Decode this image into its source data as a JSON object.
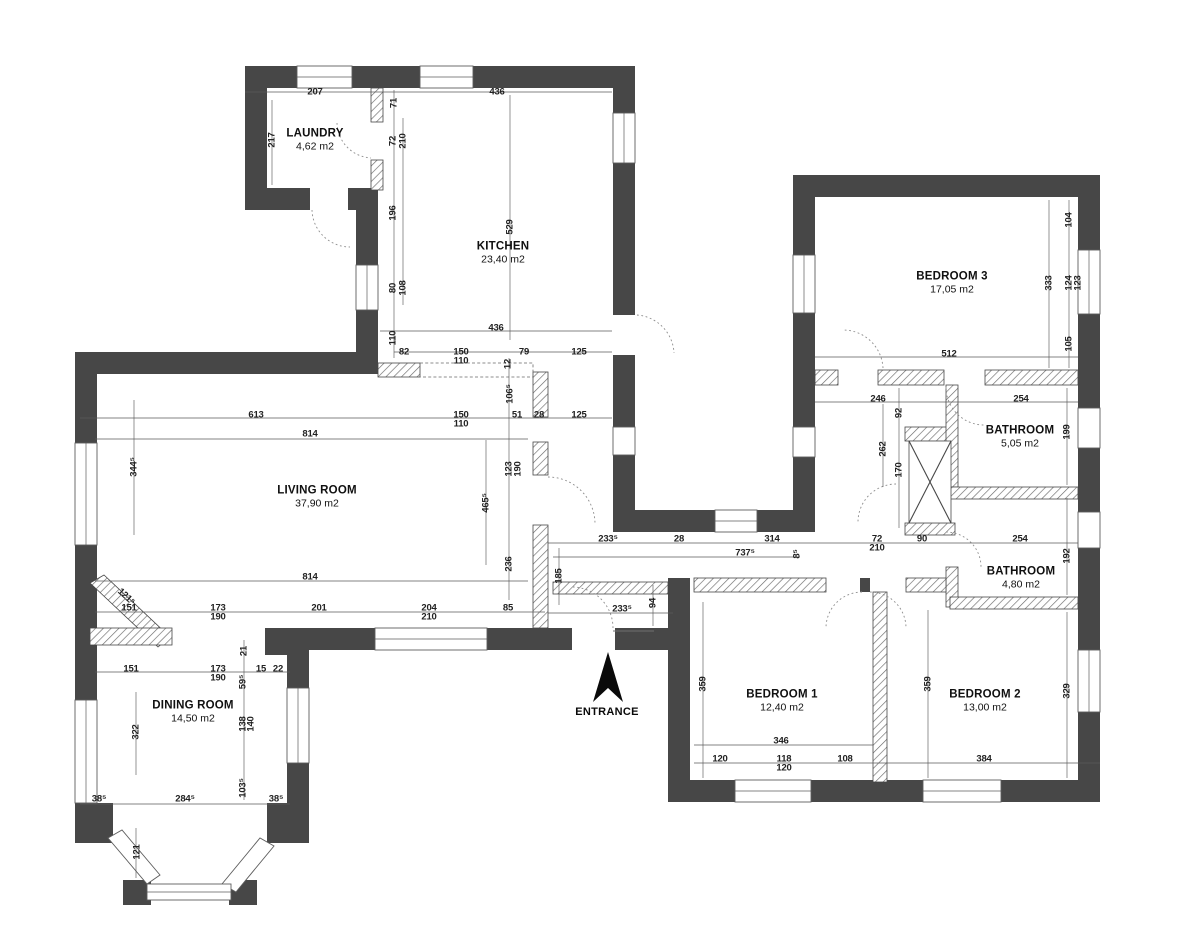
{
  "colors": {
    "wall": "#474747",
    "hatch_line": "#6a6a6a",
    "dim_text": "#222222",
    "arrow": "#0a0a0a"
  },
  "entrance": {
    "label": "ENTRANCE"
  },
  "rooms": [
    {
      "id": "laundry",
      "name": "LAUNDRY",
      "area": "4,62 m2",
      "x": 315,
      "y": 140
    },
    {
      "id": "kitchen",
      "name": "KITCHEN",
      "area": "23,40 m2",
      "x": 503,
      "y": 253
    },
    {
      "id": "living-room",
      "name": "LIVING ROOM",
      "area": "37,90 m2",
      "x": 317,
      "y": 497
    },
    {
      "id": "dining-room",
      "name": "DINING ROOM",
      "area": "14,50 m2",
      "x": 193,
      "y": 712
    },
    {
      "id": "bedroom-3",
      "name": "BEDROOM 3",
      "area": "17,05 m2",
      "x": 952,
      "y": 283
    },
    {
      "id": "bathroom-1",
      "name": "BATHROOM",
      "area": "5,05 m2",
      "x": 1020,
      "y": 437
    },
    {
      "id": "bathroom-2",
      "name": "BATHROOM",
      "area": "4,80 m2",
      "x": 1021,
      "y": 578
    },
    {
      "id": "bedroom-1",
      "name": "BEDROOM 1",
      "area": "12,40 m2",
      "x": 782,
      "y": 701
    },
    {
      "id": "bedroom-2",
      "name": "BEDROOM 2",
      "area": "13,00 m2",
      "x": 985,
      "y": 701
    }
  ],
  "dimensions": [
    {
      "t": "207",
      "x": 315,
      "y": 92,
      "r": 0
    },
    {
      "t": "436",
      "x": 497,
      "y": 92,
      "r": 0
    },
    {
      "t": "217",
      "x": 272,
      "y": 140,
      "r": 90
    },
    {
      "t": "71",
      "x": 394,
      "y": 103,
      "r": 90
    },
    {
      "t": "72",
      "x": 393,
      "y": 141,
      "r": 90
    },
    {
      "t": "210",
      "x": 403,
      "y": 141,
      "r": 90
    },
    {
      "t": "196",
      "x": 393,
      "y": 213,
      "r": 90
    },
    {
      "t": "529",
      "x": 510,
      "y": 227,
      "r": 90
    },
    {
      "t": "80",
      "x": 393,
      "y": 288,
      "r": 90
    },
    {
      "t": "108",
      "x": 403,
      "y": 288,
      "r": 90
    },
    {
      "t": "110",
      "x": 393,
      "y": 338,
      "r": 90
    },
    {
      "t": "436",
      "x": 496,
      "y": 328,
      "r": 0
    },
    {
      "t": "82",
      "x": 404,
      "y": 352,
      "r": 0
    },
    {
      "t": "150",
      "x": 461,
      "y": 352,
      "r": 0
    },
    {
      "t": "110",
      "x": 461,
      "y": 361,
      "r": 0
    },
    {
      "t": "79",
      "x": 524,
      "y": 352,
      "r": 0
    },
    {
      "t": "125",
      "x": 579,
      "y": 352,
      "r": 0
    },
    {
      "t": "12",
      "x": 508,
      "y": 364,
      "r": 90
    },
    {
      "t": "106⁵",
      "x": 510,
      "y": 394,
      "r": 90
    },
    {
      "t": "613",
      "x": 256,
      "y": 415,
      "r": 0
    },
    {
      "t": "150",
      "x": 461,
      "y": 415,
      "r": 0
    },
    {
      "t": "110",
      "x": 461,
      "y": 424,
      "r": 0
    },
    {
      "t": "51",
      "x": 517,
      "y": 415,
      "r": 0
    },
    {
      "t": "28",
      "x": 539,
      "y": 415,
      "r": 0
    },
    {
      "t": "125",
      "x": 579,
      "y": 415,
      "r": 0
    },
    {
      "t": "814",
      "x": 310,
      "y": 434,
      "r": 0
    },
    {
      "t": "344⁵",
      "x": 134,
      "y": 467,
      "r": 90
    },
    {
      "t": "123",
      "x": 509,
      "y": 469,
      "r": 90
    },
    {
      "t": "190",
      "x": 518,
      "y": 469,
      "r": 90
    },
    {
      "t": "465⁵",
      "x": 486,
      "y": 503,
      "r": 90
    },
    {
      "t": "236",
      "x": 509,
      "y": 564,
      "r": 90
    },
    {
      "t": "814",
      "x": 310,
      "y": 577,
      "r": 0
    },
    {
      "t": "151",
      "x": 129,
      "y": 608,
      "r": 0
    },
    {
      "t": "173",
      "x": 218,
      "y": 608,
      "r": 0
    },
    {
      "t": "190",
      "x": 218,
      "y": 617,
      "r": 0
    },
    {
      "t": "201",
      "x": 319,
      "y": 608,
      "r": 0
    },
    {
      "t": "204",
      "x": 429,
      "y": 608,
      "r": 0
    },
    {
      "t": "210",
      "x": 429,
      "y": 617,
      "r": 0
    },
    {
      "t": "85",
      "x": 508,
      "y": 608,
      "r": 0
    },
    {
      "t": "121⁵",
      "x": 126,
      "y": 597,
      "r": -42
    },
    {
      "t": "21",
      "x": 244,
      "y": 651,
      "r": 90
    },
    {
      "t": "151",
      "x": 131,
      "y": 669,
      "r": 0
    },
    {
      "t": "173",
      "x": 218,
      "y": 669,
      "r": 0
    },
    {
      "t": "190",
      "x": 218,
      "y": 678,
      "r": 0
    },
    {
      "t": "15",
      "x": 261,
      "y": 669,
      "r": 0
    },
    {
      "t": "22",
      "x": 278,
      "y": 669,
      "r": 0
    },
    {
      "t": "59⁵",
      "x": 243,
      "y": 682,
      "r": 90
    },
    {
      "t": "322",
      "x": 136,
      "y": 732,
      "r": 90
    },
    {
      "t": "138",
      "x": 243,
      "y": 724,
      "r": 90
    },
    {
      "t": "140",
      "x": 251,
      "y": 724,
      "r": 90
    },
    {
      "t": "103⁵",
      "x": 243,
      "y": 788,
      "r": 90
    },
    {
      "t": "38⁵",
      "x": 99,
      "y": 799,
      "r": 0
    },
    {
      "t": "284⁵",
      "x": 185,
      "y": 799,
      "r": 0
    },
    {
      "t": "38⁵",
      "x": 276,
      "y": 799,
      "r": 0
    },
    {
      "t": "121",
      "x": 137,
      "y": 852,
      "r": 90
    },
    {
      "t": "233⁵",
      "x": 608,
      "y": 539,
      "r": 0
    },
    {
      "t": "28",
      "x": 679,
      "y": 539,
      "r": 0
    },
    {
      "t": "314",
      "x": 772,
      "y": 539,
      "r": 0
    },
    {
      "t": "72",
      "x": 877,
      "y": 539,
      "r": 0
    },
    {
      "t": "210",
      "x": 877,
      "y": 548,
      "r": 0
    },
    {
      "t": "90",
      "x": 922,
      "y": 539,
      "r": 0
    },
    {
      "t": "254",
      "x": 1020,
      "y": 539,
      "r": 0
    },
    {
      "t": "737⁵",
      "x": 745,
      "y": 553,
      "r": 0
    },
    {
      "t": "8⁵",
      "x": 797,
      "y": 554,
      "r": 90
    },
    {
      "t": "185",
      "x": 559,
      "y": 576,
      "r": 90
    },
    {
      "t": "233⁵",
      "x": 622,
      "y": 609,
      "r": 0
    },
    {
      "t": "94",
      "x": 653,
      "y": 603,
      "r": 90
    },
    {
      "t": "104",
      "x": 1069,
      "y": 220,
      "r": 90
    },
    {
      "t": "333",
      "x": 1049,
      "y": 283,
      "r": 90
    },
    {
      "t": "124",
      "x": 1069,
      "y": 283,
      "r": 90
    },
    {
      "t": "123",
      "x": 1078,
      "y": 283,
      "r": 90
    },
    {
      "t": "105",
      "x": 1069,
      "y": 344,
      "r": 90
    },
    {
      "t": "512",
      "x": 949,
      "y": 354,
      "r": 0
    },
    {
      "t": "246",
      "x": 878,
      "y": 399,
      "r": 0
    },
    {
      "t": "92",
      "x": 899,
      "y": 413,
      "r": 90
    },
    {
      "t": "262",
      "x": 883,
      "y": 449,
      "r": 90
    },
    {
      "t": "170",
      "x": 899,
      "y": 470,
      "r": 90
    },
    {
      "t": "254",
      "x": 1021,
      "y": 399,
      "r": 0
    },
    {
      "t": "199",
      "x": 1067,
      "y": 432,
      "r": 90
    },
    {
      "t": "192",
      "x": 1067,
      "y": 556,
      "r": 90
    },
    {
      "t": "359",
      "x": 703,
      "y": 684,
      "r": 90
    },
    {
      "t": "359",
      "x": 928,
      "y": 684,
      "r": 90
    },
    {
      "t": "329",
      "x": 1067,
      "y": 691,
      "r": 90
    },
    {
      "t": "346",
      "x": 781,
      "y": 741,
      "r": 0
    },
    {
      "t": "120",
      "x": 720,
      "y": 759,
      "r": 0
    },
    {
      "t": "118",
      "x": 784,
      "y": 759,
      "r": 0
    },
    {
      "t": "120",
      "x": 784,
      "y": 768,
      "r": 0
    },
    {
      "t": "108",
      "x": 845,
      "y": 759,
      "r": 0
    },
    {
      "t": "384",
      "x": 984,
      "y": 759,
      "r": 0
    }
  ]
}
